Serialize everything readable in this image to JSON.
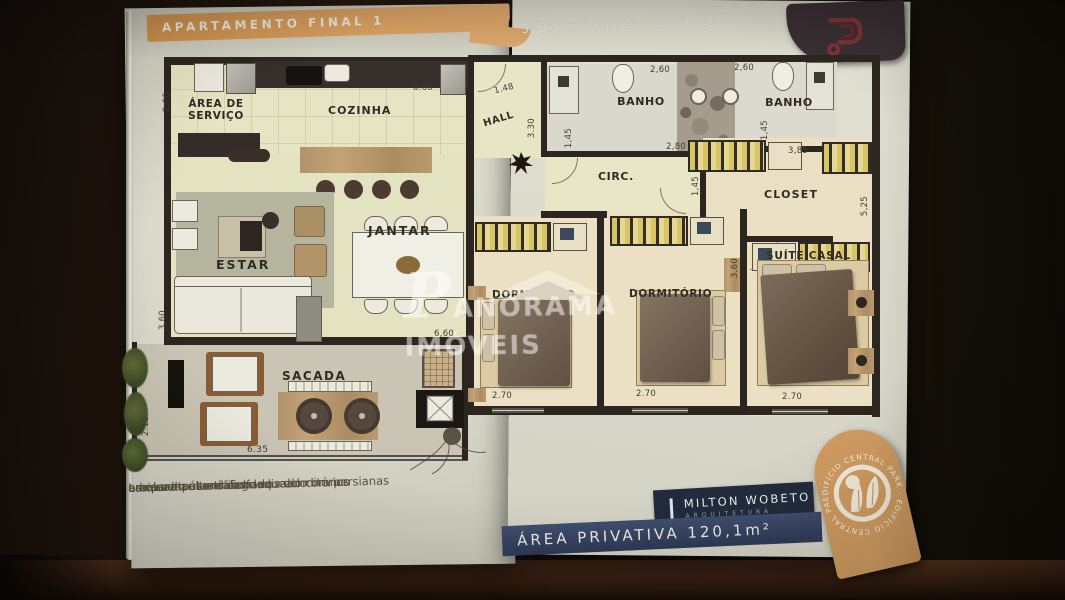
{
  "header": {
    "banner": "APARTAMENTO FINAL 1",
    "subtitle": "3 Dormitórios - 1 Suíte"
  },
  "rooms": {
    "servico": "ÁREA DE SERVIÇO",
    "cozinha": "COZINHA",
    "hall": "HALL",
    "banho1": "BANHO",
    "banho2": "BANHO",
    "circ": "CIRC.",
    "closet": "CLOSET",
    "estar": "ESTAR",
    "jantar": "JANTAR",
    "dorm1": "DORMITÓRIO",
    "dorm2": "DORMITÓRIO",
    "suite": "SUÍTE CASAL",
    "sacada": "SACADA"
  },
  "dims": {
    "cozinha_w": "6.60",
    "servico_h": "2.00",
    "hall_w": "1.48",
    "hall_h": "3.30",
    "banho1_w": "2,60",
    "banho2_w": "2,60",
    "banho1_h": "1,45",
    "banho2_h": "1,45",
    "circ_w": "2,80",
    "closet_w": "3,85",
    "closet_h": "1,45",
    "suite_side_h": "5,25",
    "estar_h": "3,60",
    "jantar_w": "6,60",
    "dorm2_h": "3,60",
    "dorm1_w": "2.70",
    "dorm2_w": "2.70",
    "suite_w": "2.70",
    "sacada_w": "6.35",
    "sacada_h": "2.12"
  },
  "watermark": "PANORAMA IMÓVEIS",
  "features": [
    "era para ar-condicionado",
    "as e rodapés em mdf laqueado branco",
    "adrias em alumínio anodizado com persianas",
    "Laminado alto tráfego nos dormitórios",
    "orcelanato nas salas"
  ],
  "architect": {
    "name": "MILTON WOBETO",
    "field": "ARQUITETURA"
  },
  "area": "ÁREA PRIVATIVA 120,1m²",
  "badge": "EDIFÍCIO CENTRAL PARK · EDIFÍCIO CENTRAL PARK ·",
  "colors": {
    "banner_orange": "#dd9f5d",
    "navy": "#35415f",
    "badge_orange": "#cf9b61",
    "wall": "#2d2620",
    "page": "#dbdacb"
  }
}
